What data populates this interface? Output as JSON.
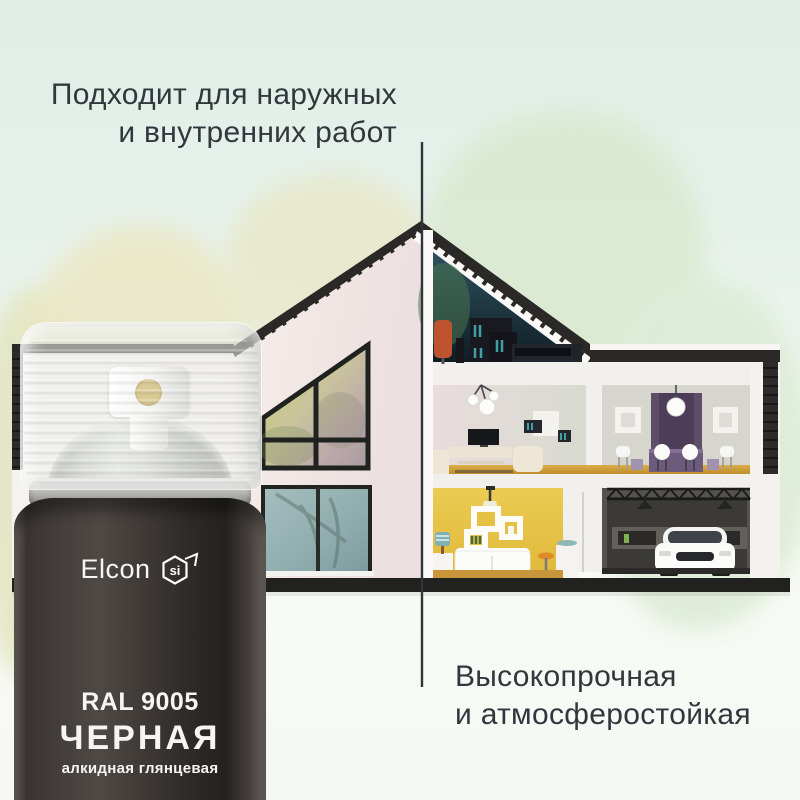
{
  "headline_top": {
    "line1": "Подходит для наружных",
    "line2": "и внутренних работ"
  },
  "headline_bottom": {
    "line1": "Высокопрочная",
    "line2": "и атмосферостойкая"
  },
  "can": {
    "brand": "Elcon",
    "badge": "si",
    "ral_code": "RAL 9005",
    "color_name": "ЧЕРНАЯ",
    "finish": "алкидная глянцевая"
  },
  "colors": {
    "headline_text": "#31373c",
    "background_mint": "#e6f1ea",
    "can_body_dark": "#3a3533",
    "can_label_text": "#f5f5f3",
    "house_wall_yellow": "#e8c64c",
    "attic_teal": "#2a4a56",
    "window_teal": "#8fadae",
    "roof_dark": "#2b2927",
    "wood_floor": "#cf9c38",
    "chair_orange": "#c2542d",
    "curtain_purple": "#5e4c68"
  }
}
